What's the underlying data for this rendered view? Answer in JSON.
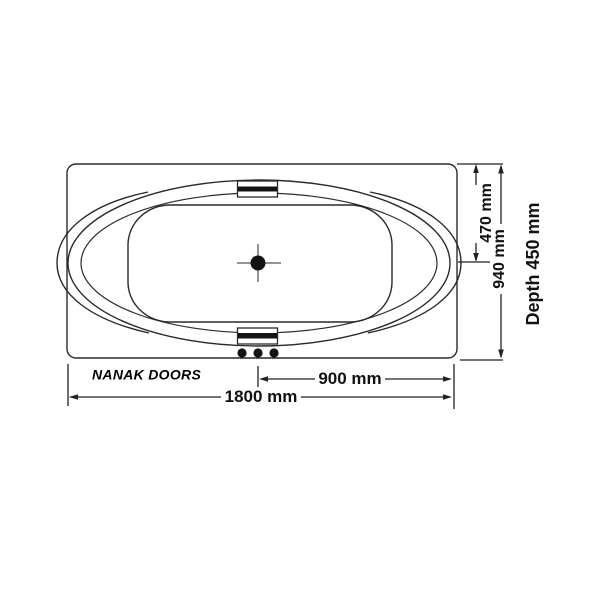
{
  "title": "Bathtub top-view technical drawing",
  "brand": {
    "label": "NANAK DOORS"
  },
  "dimensions": {
    "inner_half_width": {
      "label": "470 mm",
      "value_mm": 470,
      "orientation": "vertical"
    },
    "overall_width": {
      "label": "940 mm",
      "value_mm": 940,
      "orientation": "vertical"
    },
    "depth": {
      "label": "Depth 450 mm",
      "value_mm": 450,
      "orientation": "vertical"
    },
    "half_length": {
      "label": "900 mm",
      "value_mm": 900,
      "orientation": "horizontal"
    },
    "overall_length": {
      "label": "1800 mm",
      "value_mm": 1800,
      "orientation": "horizontal"
    }
  },
  "features": {
    "drain": "center drain with crosshair",
    "headrest_count": 2,
    "jet_button_count": 3
  },
  "colors": {
    "background": "#ffffff",
    "line": "#2a2a2a",
    "text": "#111111"
  }
}
